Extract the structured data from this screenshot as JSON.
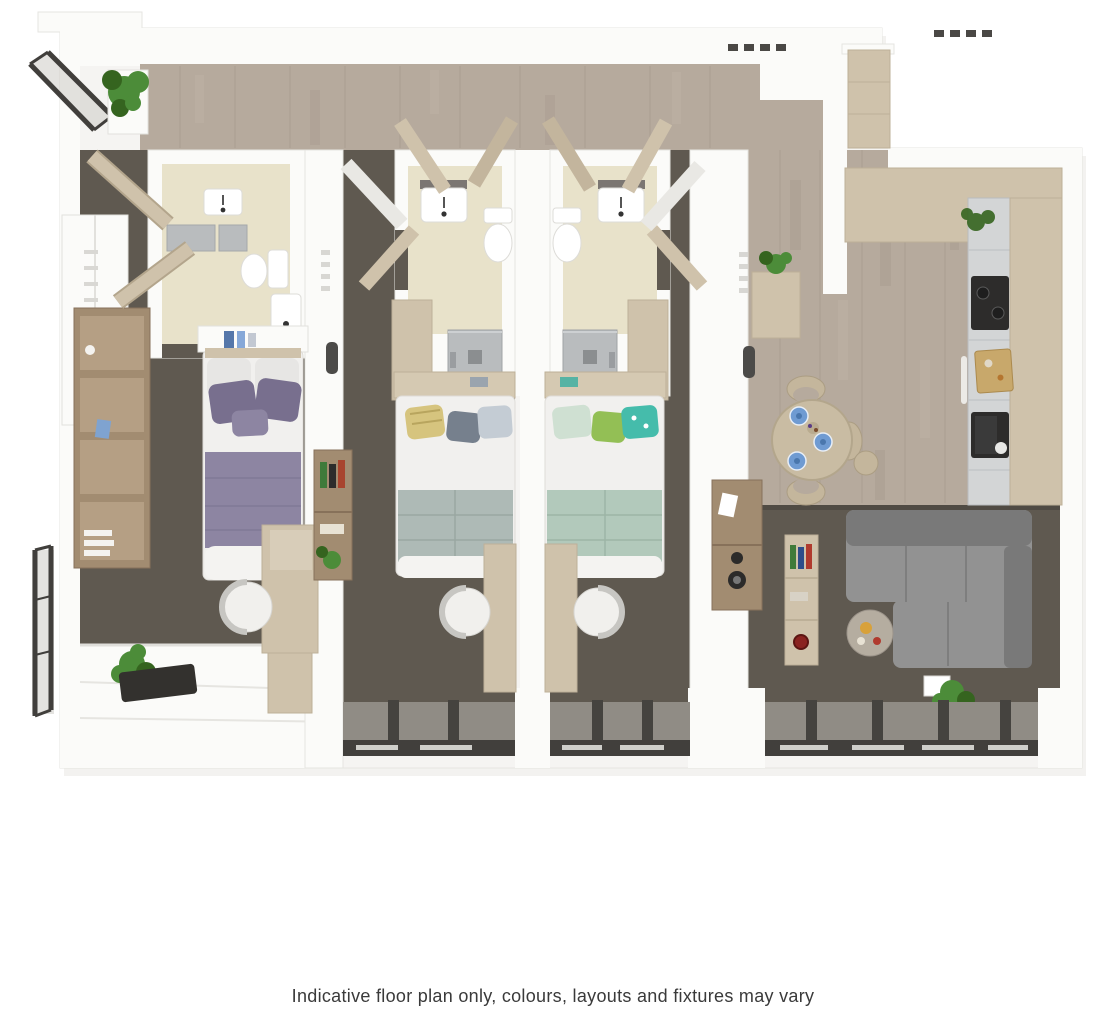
{
  "caption": {
    "text": "Indicative floor plan only, colours, layouts and fixtures may vary"
  },
  "palette": {
    "page_bg": "#ffffff",
    "slab": "#f5f4f2",
    "wall": "#fbfbf9",
    "wall_edge": "#e2e1dd",
    "wood": "#b6aa9d",
    "wood_dark": "#a09487",
    "wood_light": "#c6bbae",
    "carpet": "#5f5950",
    "bath_floor": "#e8e2ca",
    "shower": "#b9bcbe",
    "beige": "#cfc2ab",
    "beige_dark": "#b3a58c",
    "marble": "#d3d5d6",
    "marble_dark": "#b9bcbe",
    "black": "#2d2c2b",
    "sofa": "#929292",
    "sofa_dark": "#797979",
    "purple": "#8d85a2",
    "purple_dark": "#786f8e",
    "sage": "#b2c9bb",
    "graygreen": "#aebab6",
    "wood_shelf": "#a28c71",
    "wood_shelf_dark": "#87715a",
    "plant": "#4c8c39",
    "plant_dark": "#35641f",
    "frame": "#413f3c",
    "frame_light": "#908c85",
    "glass": "#c9c7c2",
    "table": "#c9bca3",
    "chair_tan": "#c4b69c",
    "plate": "#6f9bd2",
    "text": "#3a3a3a"
  },
  "floorplan": {
    "style": "3d-top-down-render",
    "rooms": [
      "hallway",
      "bedroom-1",
      "ensuite-1",
      "bedroom-2",
      "ensuite-2",
      "bedroom-3",
      "ensuite-3",
      "kitchen",
      "dining-area",
      "living-area",
      "balcony"
    ],
    "features": [
      "beds-3",
      "desks-3",
      "wardrobes",
      "toilets",
      "sinks",
      "showers",
      "kitchen-counter",
      "hob",
      "dining-table",
      "sofa",
      "plants",
      "floor-to-ceiling-windows",
      "balcony-railings"
    ]
  }
}
